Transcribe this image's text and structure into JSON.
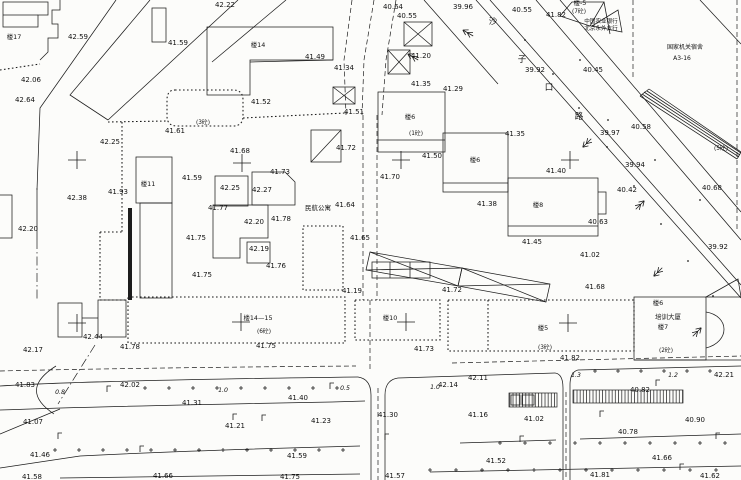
{
  "meta": {
    "width": 741,
    "height": 480,
    "background": "#fcfcfa",
    "ink": "#1d1d1d",
    "description": "topographic cadastral site plan, black ink on white"
  },
  "labels": {
    "spot_elevations": [
      {
        "x": 225,
        "y": 7,
        "t": "42.22"
      },
      {
        "x": 78,
        "y": 39,
        "t": "42.59"
      },
      {
        "x": 178,
        "y": 45,
        "t": "41.59"
      },
      {
        "x": 31,
        "y": 82,
        "t": "42.06"
      },
      {
        "x": 25,
        "y": 102,
        "t": "42.64"
      },
      {
        "x": 110,
        "y": 144,
        "t": "42.25"
      },
      {
        "x": 393,
        "y": 9,
        "t": "40.64"
      },
      {
        "x": 407,
        "y": 18,
        "t": "40.55"
      },
      {
        "x": 463,
        "y": 9,
        "t": "39.96"
      },
      {
        "x": 522,
        "y": 12,
        "t": "40.55"
      },
      {
        "x": 556,
        "y": 17,
        "t": "41.82"
      },
      {
        "x": 315,
        "y": 59,
        "t": "41.49"
      },
      {
        "x": 344,
        "y": 70,
        "t": "41.34"
      },
      {
        "x": 261,
        "y": 104,
        "t": "41.52"
      },
      {
        "x": 354,
        "y": 114,
        "t": "41.51"
      },
      {
        "x": 175,
        "y": 133,
        "t": "41.61"
      },
      {
        "x": 240,
        "y": 153,
        "t": "41.68"
      },
      {
        "x": 346,
        "y": 150,
        "t": "41.72"
      },
      {
        "x": 421,
        "y": 58,
        "t": "41.20"
      },
      {
        "x": 421,
        "y": 86,
        "t": "41.35"
      },
      {
        "x": 453,
        "y": 91,
        "t": "41.29"
      },
      {
        "x": 515,
        "y": 136,
        "t": "41.35"
      },
      {
        "x": 556,
        "y": 173,
        "t": "41.40"
      },
      {
        "x": 432,
        "y": 158,
        "t": "41.50"
      },
      {
        "x": 390,
        "y": 179,
        "t": "41.70"
      },
      {
        "x": 487,
        "y": 206,
        "t": "41.38"
      },
      {
        "x": 532,
        "y": 244,
        "t": "41.45"
      },
      {
        "x": 535,
        "y": 72,
        "t": "39.92"
      },
      {
        "x": 593,
        "y": 72,
        "t": "40.45"
      },
      {
        "x": 610,
        "y": 135,
        "t": "39.97"
      },
      {
        "x": 641,
        "y": 129,
        "t": "40.58"
      },
      {
        "x": 635,
        "y": 167,
        "t": "39.94"
      },
      {
        "x": 627,
        "y": 192,
        "t": "40.42"
      },
      {
        "x": 598,
        "y": 224,
        "t": "40.63"
      },
      {
        "x": 712,
        "y": 190,
        "t": "40.68"
      },
      {
        "x": 718,
        "y": 249,
        "t": "39.92"
      },
      {
        "x": 192,
        "y": 180,
        "t": "41.59"
      },
      {
        "x": 230,
        "y": 190,
        "t": "42.25"
      },
      {
        "x": 262,
        "y": 192,
        "t": "42.27"
      },
      {
        "x": 280,
        "y": 174,
        "t": "41.73"
      },
      {
        "x": 218,
        "y": 210,
        "t": "41.77"
      },
      {
        "x": 254,
        "y": 224,
        "t": "42.20"
      },
      {
        "x": 281,
        "y": 221,
        "t": "41.78"
      },
      {
        "x": 196,
        "y": 240,
        "t": "41.75"
      },
      {
        "x": 259,
        "y": 251,
        "t": "42.19"
      },
      {
        "x": 276,
        "y": 268,
        "t": "41.76"
      },
      {
        "x": 202,
        "y": 277,
        "t": "41.75"
      },
      {
        "x": 118,
        "y": 194,
        "t": "41.93"
      },
      {
        "x": 77,
        "y": 200,
        "t": "42.38"
      },
      {
        "x": 28,
        "y": 231,
        "t": "42.20"
      },
      {
        "x": 345,
        "y": 207,
        "t": "41.64"
      },
      {
        "x": 360,
        "y": 240,
        "t": "41.65"
      },
      {
        "x": 590,
        "y": 257,
        "t": "41.02"
      },
      {
        "x": 595,
        "y": 289,
        "t": "41.68"
      },
      {
        "x": 33,
        "y": 352,
        "t": "42.17"
      },
      {
        "x": 93,
        "y": 339,
        "t": "42.44"
      },
      {
        "x": 130,
        "y": 349,
        "t": "41.78"
      },
      {
        "x": 266,
        "y": 348,
        "t": "41.75"
      },
      {
        "x": 424,
        "y": 351,
        "t": "41.73"
      },
      {
        "x": 352,
        "y": 293,
        "t": "41.19"
      },
      {
        "x": 452,
        "y": 292,
        "t": "41.72"
      },
      {
        "x": 570,
        "y": 360,
        "t": "41.82"
      },
      {
        "x": 25,
        "y": 387,
        "t": "41.83"
      },
      {
        "x": 130,
        "y": 387,
        "t": "42.02"
      },
      {
        "x": 192,
        "y": 405,
        "t": "41.31"
      },
      {
        "x": 298,
        "y": 400,
        "t": "41.40"
      },
      {
        "x": 321,
        "y": 423,
        "t": "41.23"
      },
      {
        "x": 235,
        "y": 428,
        "t": "41.21"
      },
      {
        "x": 33,
        "y": 424,
        "t": "41.07"
      },
      {
        "x": 388,
        "y": 417,
        "t": "41.30"
      },
      {
        "x": 478,
        "y": 417,
        "t": "41.16"
      },
      {
        "x": 448,
        "y": 387,
        "t": "42.14"
      },
      {
        "x": 478,
        "y": 380,
        "t": "42.11"
      },
      {
        "x": 640,
        "y": 392,
        "t": "40.82"
      },
      {
        "x": 724,
        "y": 377,
        "t": "42.21"
      },
      {
        "x": 534,
        "y": 421,
        "t": "41.02"
      },
      {
        "x": 628,
        "y": 434,
        "t": "40.78"
      },
      {
        "x": 695,
        "y": 422,
        "t": "40.90"
      },
      {
        "x": 40,
        "y": 457,
        "t": "41.46"
      },
      {
        "x": 297,
        "y": 458,
        "t": "41.59"
      },
      {
        "x": 496,
        "y": 463,
        "t": "41.52"
      },
      {
        "x": 662,
        "y": 460,
        "t": "41.66"
      },
      {
        "x": 32,
        "y": 479,
        "t": "41.58"
      },
      {
        "x": 163,
        "y": 478,
        "t": "41.66"
      },
      {
        "x": 290,
        "y": 479,
        "t": "41.75"
      },
      {
        "x": 395,
        "y": 478,
        "t": "41.57"
      },
      {
        "x": 600,
        "y": 477,
        "t": "41.81"
      },
      {
        "x": 710,
        "y": 478,
        "t": "41.62"
      }
    ],
    "road_widths": [
      {
        "x": 60,
        "y": 394,
        "t": "0.8"
      },
      {
        "x": 223,
        "y": 392,
        "t": "1.0"
      },
      {
        "x": 345,
        "y": 390,
        "t": "0.5"
      },
      {
        "x": 435,
        "y": 389,
        "t": "1.0"
      },
      {
        "x": 576,
        "y": 377,
        "t": "1.3"
      },
      {
        "x": 673,
        "y": 377,
        "t": "1.2"
      }
    ],
    "structure_notes": [
      {
        "x": 579,
        "y": 13,
        "t": "(7砼)"
      },
      {
        "x": 416,
        "y": 135,
        "t": "(1砼)"
      },
      {
        "x": 203,
        "y": 124,
        "t": "(3砼)"
      },
      {
        "x": 264,
        "y": 333,
        "t": "(6砼)"
      },
      {
        "x": 545,
        "y": 349,
        "t": "(3砼)"
      },
      {
        "x": 666,
        "y": 352,
        "t": "(2砼)"
      },
      {
        "x": 721,
        "y": 150,
        "t": "(5砼)"
      }
    ],
    "building_numbers": [
      {
        "x": 14,
        "y": 39,
        "t": "楼17"
      },
      {
        "x": 258,
        "y": 47,
        "t": "楼14"
      },
      {
        "x": 580,
        "y": 5,
        "t": "楼-5"
      },
      {
        "x": 148,
        "y": 186,
        "t": "楼11"
      },
      {
        "x": 410,
        "y": 119,
        "t": "楼6"
      },
      {
        "x": 475,
        "y": 162,
        "t": "楼6"
      },
      {
        "x": 538,
        "y": 207,
        "t": "楼8"
      },
      {
        "x": 258,
        "y": 320,
        "t": "楼14—15"
      },
      {
        "x": 390,
        "y": 320,
        "t": "楼10"
      },
      {
        "x": 543,
        "y": 330,
        "t": "楼5"
      },
      {
        "x": 663,
        "y": 329,
        "t": "楼7"
      },
      {
        "x": 658,
        "y": 305,
        "t": "楼6"
      }
    ],
    "names": [
      {
        "x": 601,
        "y": 23,
        "t": "中国农业银行",
        "size": 5.6
      },
      {
        "x": 601,
        "y": 30,
        "t": "北京永外支行",
        "size": 5.6
      },
      {
        "x": 685,
        "y": 49,
        "t": "国家机关宿舍",
        "size": 6
      },
      {
        "x": 682,
        "y": 60,
        "t": "A3-16",
        "size": 6
      },
      {
        "x": 318,
        "y": 210,
        "t": "民航公寓",
        "size": 6.5
      },
      {
        "x": 668,
        "y": 319,
        "t": "培训大厦",
        "size": 6.5
      }
    ],
    "street_name_chars": [
      {
        "x": 493,
        "y": 24,
        "t": "沙"
      },
      {
        "x": 522,
        "y": 62,
        "t": "子"
      },
      {
        "x": 549,
        "y": 90,
        "t": "口"
      },
      {
        "x": 579,
        "y": 119,
        "t": "路"
      }
    ]
  },
  "symbols": {
    "survey_crosses": [
      [
        77,
        160
      ],
      [
        242,
        163
      ],
      [
        401,
        160
      ],
      [
        570,
        160
      ],
      [
        77,
        323
      ],
      [
        241,
        322
      ],
      [
        406,
        322
      ],
      [
        568,
        323
      ]
    ],
    "street_lamps": [
      [
        107,
        392
      ],
      [
        330,
        389
      ],
      [
        656,
        386
      ],
      [
        233,
        420
      ],
      [
        262,
        421
      ],
      [
        58,
        439
      ],
      [
        140,
        452
      ],
      [
        385,
        440
      ],
      [
        716,
        439
      ],
      [
        600,
        417
      ],
      [
        520,
        442
      ],
      [
        680,
        470
      ]
    ],
    "traffic_arrows": [
      {
        "x": 413,
        "y": 57,
        "r": -60
      },
      {
        "x": 468,
        "y": 33,
        "r": -60
      },
      {
        "x": 587,
        "y": 143,
        "r": -135
      },
      {
        "x": 640,
        "y": 205,
        "r": 45
      },
      {
        "x": 658,
        "y": 272,
        "r": -135
      },
      {
        "x": 697,
        "y": 332,
        "r": 45
      }
    ],
    "plus_rows": [
      {
        "x0": 145,
        "y": 388,
        "step": 24,
        "n": 9
      },
      {
        "x0": 500,
        "y": 443,
        "step": 25,
        "n": 10
      },
      {
        "x0": 55,
        "y": 450,
        "step": 24,
        "n": 13
      },
      {
        "x0": 430,
        "y": 470,
        "step": 26,
        "n": 12
      },
      {
        "x0": 595,
        "y": 371,
        "step": 23,
        "n": 6
      }
    ],
    "point_dots": [
      [
        525,
        40
      ],
      [
        553,
        74
      ],
      [
        579,
        108
      ],
      [
        607,
        147
      ],
      [
        634,
        186
      ],
      [
        661,
        224
      ],
      [
        688,
        261
      ],
      [
        713,
        296
      ],
      [
        608,
        120
      ],
      [
        655,
        160
      ],
      [
        700,
        200
      ],
      [
        580,
        60
      ]
    ]
  },
  "geometry": {
    "solid": [
      "M3,2 H48 V15 H38 V27 H3 Z",
      "M3,15 H38",
      "M60,0 V10 H52 V24 H58 V38 H48 V52 L40,60",
      "M116,0 L40,108 L37,190",
      "M150,0 L70,95 L108,120",
      "M238,0 L108,120",
      "M286,0 L212,62",
      "M152,8 H166 V42 H152 Z",
      "M0,195 H12 V238 H0",
      "M37,188 V240",
      "M207,27 H333 V60 H250 V95 H207 Z",
      "M250,62 L333,60",
      "M378,92 H445 V152 H378 Z",
      "M378,140 H445",
      "M443,133 H508 V192 H443 Z",
      "M443,183 H508",
      "M508,178 H598 V236 H508 Z",
      "M508,226 H598",
      "M598,192 H606 V214 H598",
      "M215,176 H248 V206 H215 Z",
      "M252,172 H285 L295,182 V205 H252 Z",
      "M213,205 H268 V238 H240 V258 H213 Z",
      "M247,242 H270 V263 H247 Z",
      "M136,157 H172 V203 H136 Z",
      "M140,203 H172 V298 H140 Z",
      "M311,130 H341 V162 H311 Z",
      "M311,162 L341,130",
      "M58,303 H82 V337 H58 Z",
      "M98,300 H126 V337 H98 Z",
      "M82,318 H98",
      "M56,366 Q18,390 54,414",
      "M634,297 H706 V360 H634 Z",
      "M706,297 L738,279 L741,297 Z",
      "M706,312 C730,316 730,342 706,348",
      "M634,360 H741",
      "M0,386 C60,382 200,379 358,377",
      "M398,378 L555,373",
      "M578,370 L741,366",
      "M358,377 Q371,379 371,395 L371,480",
      "M398,378 Q385,380 385,395 L385,480",
      "M555,373 Q563,374 563,388 L563,480",
      "M578,370 Q570,372 570,385 L570,480",
      "M0,410 C80,407 220,404 332,402",
      "M332,402 L365,401",
      "M0,434 L60,409",
      "M0,468 Q40,462 80,456 C180,451 280,448 360,446",
      "M460,443 L556,440",
      "M580,439 L741,434",
      "M60,478 L360,474",
      "M430,472 L741,466",
      "M476,0 L741,298",
      "M490,0 L741,285",
      "M536,0 L741,240",
      "M560,0 L741,212",
      "M424,0 L498,84",
      "M700,0 L741,44",
      "M572,2 L604,2 L590,26 L560,16 Z",
      "M592,26 L618,10 L622,32 Z",
      "M604,2 L610,34",
      "M640,96 L737,159",
      "M642,94 L739,157",
      "M644,92 L740,155",
      "M647,91 L741,153",
      "M649,89 L741,152",
      "M640,96 L649,89",
      "M737,159 L741,152",
      "M370,252 L462,268 L458,286 L366,270 Z",
      "M370,252 L458,286",
      "M366,270 L462,268",
      "M462,268 L550,284 L546,302 L458,286 Z",
      "M462,268 L546,302",
      "M550,284 L458,286",
      "M372,262 H430 V278 H372 Z",
      "M390,262 V278",
      "M410,262 V278",
      "M511,395 H520 V405 H511 Z",
      "M522,395 H534 V405 H522 Z"
    ],
    "dashed": [
      "M0,371 C80,369 220,367 356,366",
      "M452,363 L741,356",
      "M352,0 L344,60 L346,115",
      "M374,0 L364,60 L362,115",
      "M396,0 L386,60 L382,115",
      "M363,115 V300",
      "M377,115 V300",
      "M370,300 V370",
      "M378,388 V480",
      "M566,392 V480",
      "M633,0 V80",
      "M737,0 V230"
    ],
    "walls": [
      "M108,122 L167,121",
      "M243,118 L345,113",
      "M122,122 V232",
      "M100,232 V300",
      "M100,232 H122",
      "M100,300 H128",
      "M0,70 L40,64",
      "M175,90 H233 Q243,90 243,100 V116 Q243,126 233,126 H177 Q167,126 167,116 V100 Q167,90 175,90 Z",
      "M128,297 H345 V343 H128 Z",
      "M355,300 H440 V340 H355 Z",
      "M448,300 H634 V351 H448 Z",
      "M488,300 V351",
      "M303,226 H343 V290 H303 Z"
    ],
    "dashdot": [
      "M37,240 V300",
      "M95,345 L58,404"
    ],
    "filled": [
      "M128,208 H132 V300 H128 Z"
    ],
    "xsheds": [
      [
        404,
        22,
        28,
        24
      ],
      [
        388,
        50,
        22,
        24
      ],
      [
        333,
        87,
        22,
        17
      ]
    ],
    "hatch_rects": [
      [
        509,
        393,
        48,
        14
      ],
      [
        573,
        390,
        110,
        13
      ]
    ]
  }
}
